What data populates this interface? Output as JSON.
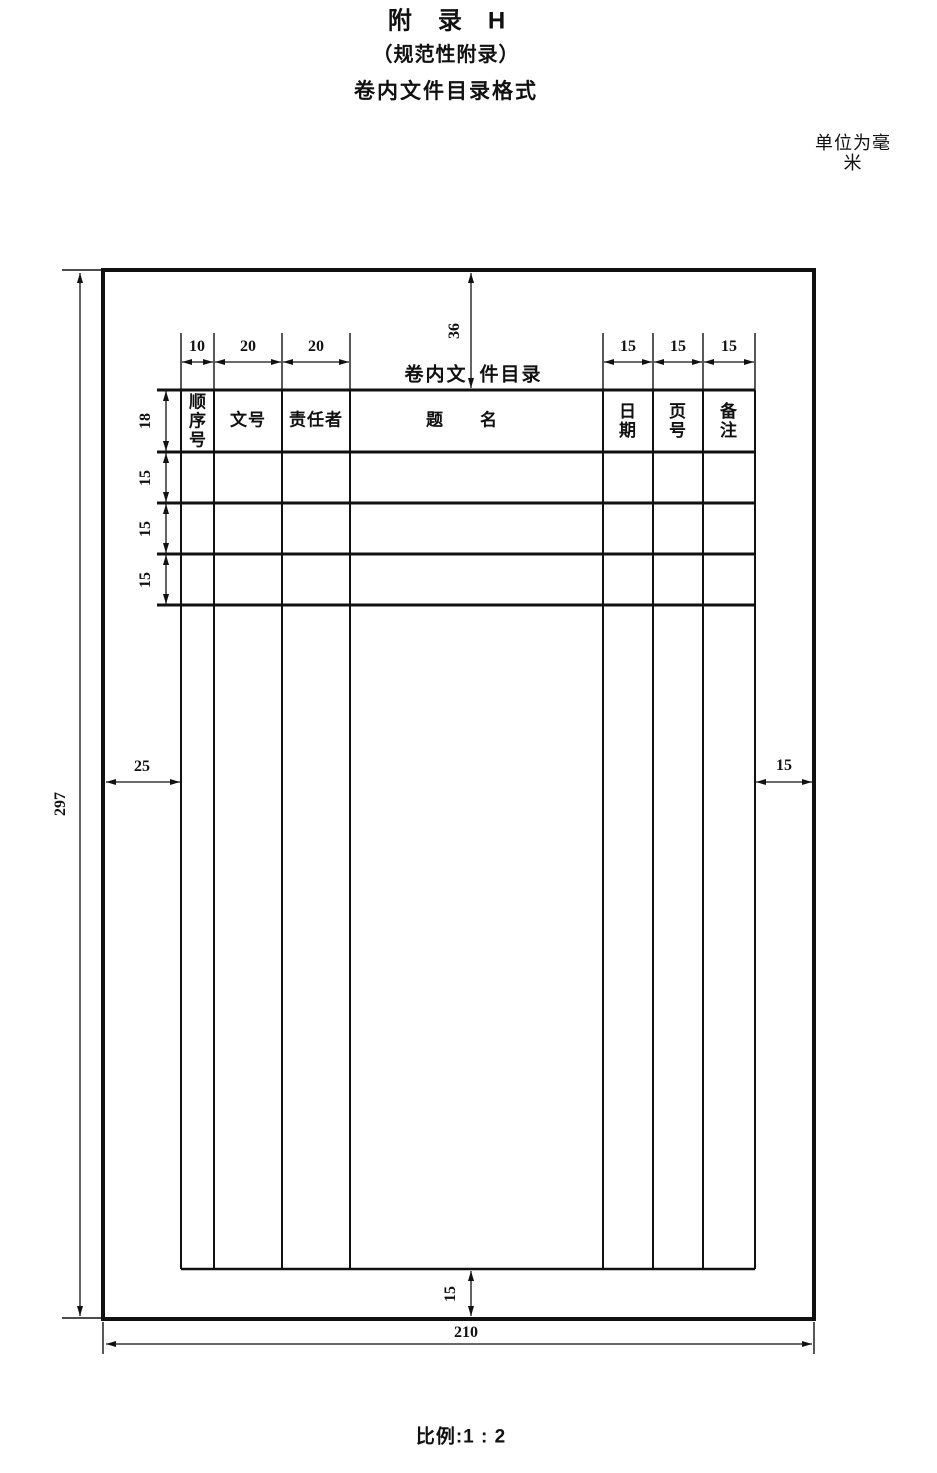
{
  "document": {
    "appendix_title": "附　录　H",
    "appendix_subtitle": "（规范性附录）",
    "appendix_heading": "卷内文件目录格式",
    "unit_note": "单位为毫米",
    "scale_note": "比例:1 : 2"
  },
  "form": {
    "title_left": "卷内文",
    "title_right": "件目录",
    "headers": {
      "seq": "顺\n序\n号",
      "doc_no": "文号",
      "author": "责任者",
      "title": "题　　名",
      "date": "日\n期",
      "page_no": "页\n号",
      "remark": "备\n注"
    }
  },
  "dimensions": {
    "col_widths": [
      "10",
      "20",
      "20",
      "15",
      "15",
      "15"
    ],
    "row_heights": [
      "18",
      "15",
      "15",
      "15"
    ],
    "top_margin": "36",
    "left_margin": "25",
    "right_margin": "15",
    "bottom_gap": "15",
    "page_height": "297",
    "page_width": "210"
  }
}
